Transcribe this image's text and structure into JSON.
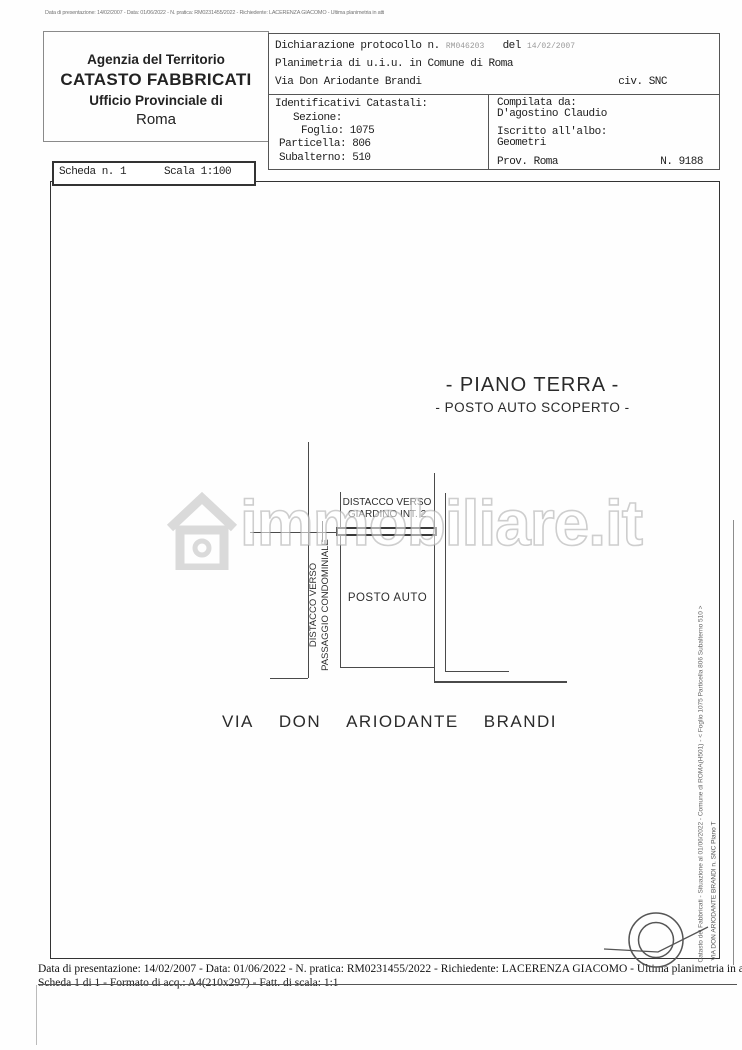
{
  "scan_header_line": "Data di presentazione: 14/02/2007 - Data: 01/06/2022 - N. pratica: RM0231455/2022 - Richiedente: LACERENZA GIACOMO - Ultima planimetria in atti",
  "agency_box": {
    "line1": "Agenzia del Territorio",
    "line2": "CATASTO FABBRICATI",
    "line3": "Ufficio Provinciale di",
    "line4": "Roma"
  },
  "declaration_box": {
    "protocol_label": "Dichiarazione protocollo n.",
    "protocol_number": "RM046203",
    "del_label": "del",
    "protocol_date": "14/02/2007",
    "line2": "Planimetria di u.i.u. in Comune di Roma",
    "street": "Via Don Ariodante Brandi",
    "civ": "civ. SNC"
  },
  "catastal_box": {
    "title": "Identificativi Catastali:",
    "sezione": "Sezione:",
    "foglio": "Foglio: 1075",
    "particella": "Particella: 806",
    "subalterno": "Subalterno: 510",
    "compilata_label": "Compilata da:",
    "compilata_name": "D'agostino Claudio",
    "albo_label": "Iscritto all'albo:",
    "albo_value": "Geometri",
    "prov": "Prov. Roma",
    "numero": "N. 9188"
  },
  "scheda_box": {
    "scheda": "Scheda n. 1",
    "scala": "Scala 1:100"
  },
  "plan": {
    "title1": "- PIANO TERRA -",
    "title2": "- POSTO AUTO SCOPERTO -",
    "distacco_giardino_line1": "DISTACCO VERSO",
    "distacco_giardino_line2": "GIARDINO INT. 2",
    "distacco_passaggio_line1": "DISTACCO VERSO",
    "distacco_passaggio_line2": "PASSAGGIO CONDOMINIALE",
    "posto_auto": "POSTO AUTO",
    "street_words": [
      "VIA",
      "DON",
      "ARIODANTE",
      "BRANDI"
    ]
  },
  "watermark": {
    "text": "immobiliare.it"
  },
  "side_text": {
    "line1": "Catasto dei Fabbricati - Situazione al 01/06/2022 - Comune di ROMA(H501) - < Foglio 1075 Particella 806 Subalterno 510 >",
    "line2": "VIA DON ARIODANTE BRANDI n. SNC Piano T"
  },
  "footer": {
    "line1": "Data di presentazione: 14/02/2007 - Data: 01/06/2022 - N. pratica: RM0231455/2022 - Richiedente: LACERENZA GIACOMO - Ultima planimetria in atti",
    "line2": "Scheda 1 di 1 - Formato di acq.: A4(210x297) - Fatt. di scala: 1:1"
  }
}
